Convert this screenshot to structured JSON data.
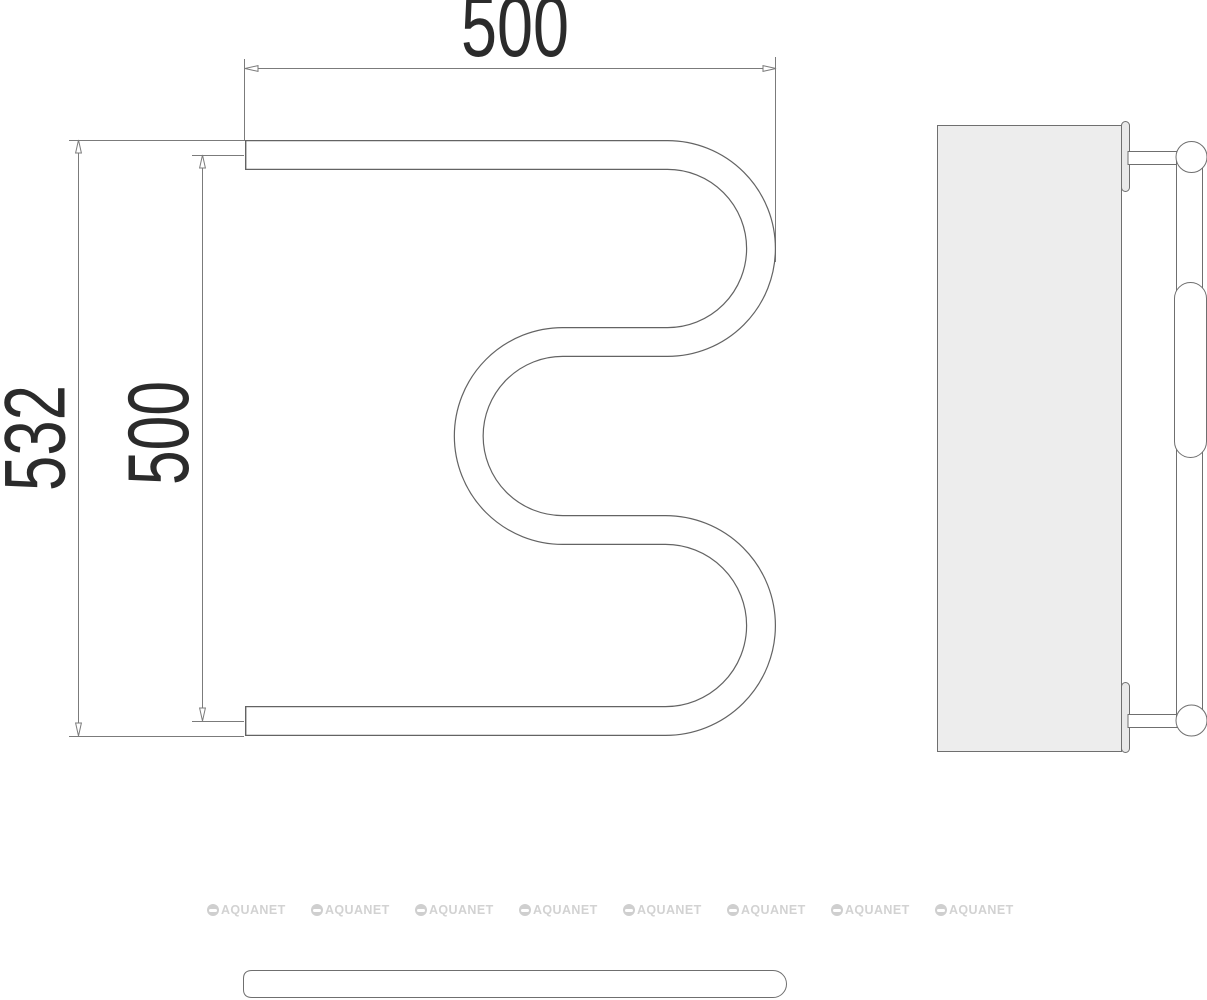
{
  "front_view": {
    "dim_width": "500",
    "dim_overall_height": "532",
    "dim_axis_height": "500"
  },
  "watermark": {
    "label": "AQUANET",
    "count": 8
  },
  "colors": {
    "dim_line_gray": "#7b7b7b",
    "pipe_outline_gray": "#636363",
    "side_view_line_gray": "#6f6f6f",
    "panel_fill": "#ededed",
    "dim_text": "#2b2b2b",
    "watermark_gray": "#d2d2d2"
  }
}
